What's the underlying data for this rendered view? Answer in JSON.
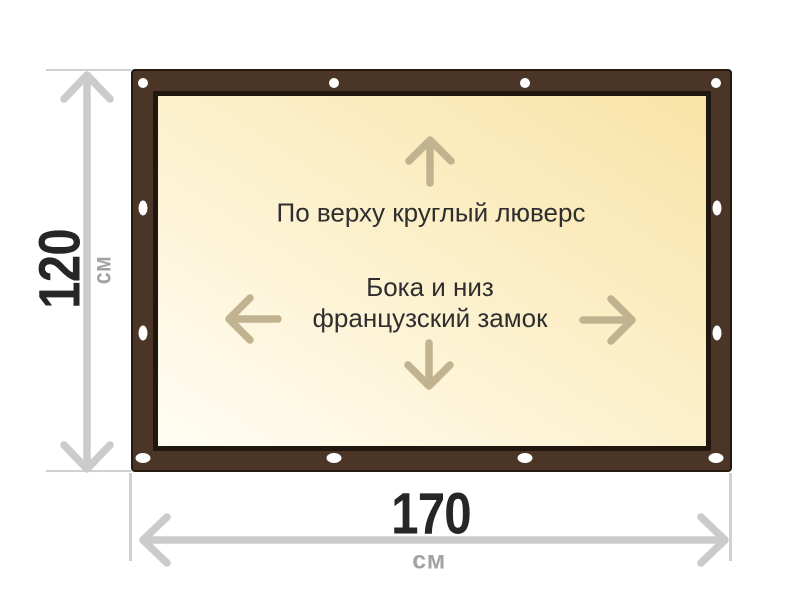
{
  "diagram": {
    "annotations": {
      "top": "По верху круглый люверс",
      "middle_line1": "Бока и низ",
      "middle_line2": "французский замок"
    },
    "height_dimension": {
      "value": "120",
      "unit": "см"
    },
    "width_dimension": {
      "value": "170",
      "unit": "см"
    },
    "grommet_count": 12
  },
  "colors": {
    "page_bg": "#ffffff",
    "frame_brown": "#4a3526",
    "frame_outline": "#241a10",
    "inner_border": "#20170f",
    "canvas_light": "#fffdf4",
    "canvas_mid": "#fcefc8",
    "canvas_yellow": "#f9e3a7",
    "inner_arrow": "#c2b390",
    "dimension_line": "#cbcbcb",
    "extension_line": "#d0d0d0",
    "dimension_text": "#262626",
    "unit_text": "#a2a2a2",
    "annotation_text": "#2e2e2e",
    "grommet": "#ffffff"
  }
}
